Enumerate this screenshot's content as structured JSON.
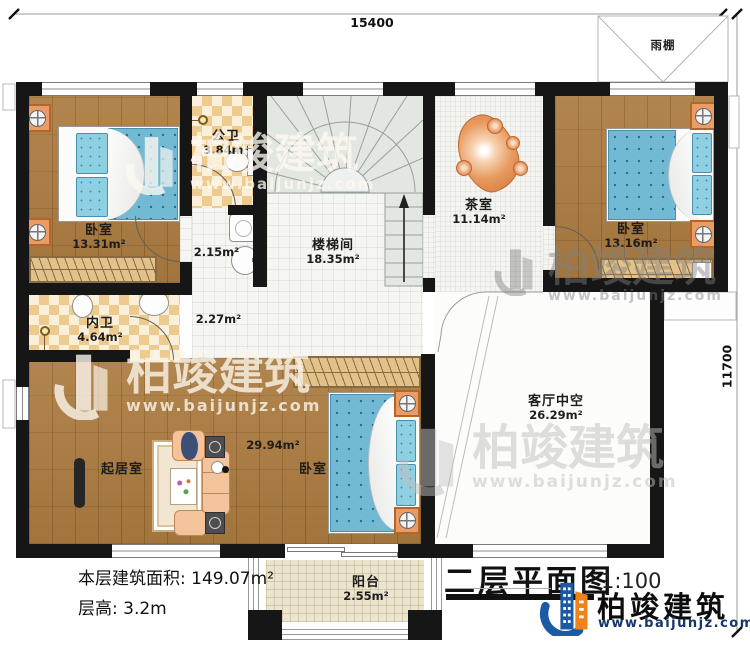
{
  "dimensions": {
    "width": "15400",
    "height": "11700"
  },
  "rooms": {
    "bedroom1": {
      "name": "卧室",
      "area": "13.31m²"
    },
    "public_bath": {
      "name": "公卫",
      "area": "3.84m²"
    },
    "wash_nook": {
      "area": "2.15m²"
    },
    "hallway": {
      "area": "2.27m²"
    },
    "stair_hall": {
      "name": "楼梯间",
      "area": "18.35m²"
    },
    "tea_room": {
      "name": "茶室",
      "area": "11.14m²"
    },
    "bedroom2": {
      "name": "卧室",
      "area": "13.16m²"
    },
    "private_bath": {
      "name": "内卫",
      "area": "4.64m²"
    },
    "living_room": {
      "name": "起居室"
    },
    "bedroom3": {
      "name": "卧室",
      "area": "29.94m²"
    },
    "void": {
      "name": "客厅中空",
      "area": "26.29m²"
    },
    "balcony": {
      "name": "阳台",
      "area": "2.55m²"
    },
    "canopy": {
      "name": "雨棚"
    }
  },
  "info": {
    "floor_area": "本层建筑面积: 149.07m²",
    "floor_height": "层高: 3.2m"
  },
  "titleblock": {
    "title": "二层平面图",
    "scale": "1:100"
  },
  "brand": {
    "name": "柏竣建筑",
    "url": "www.baijunjz.com"
  },
  "watermark": {
    "name": "柏竣建筑",
    "url": "www.baijunjz.com"
  },
  "colors": {
    "wall": "#161616",
    "wood": "#ab7c40",
    "checker": "#edca8e",
    "bed_blue": "#72bad4",
    "nightstand_orange": "#eb9c64",
    "logo_blue": "#1d5aa5",
    "logo_orange": "#ef8218",
    "url_blue": "#18356b"
  }
}
